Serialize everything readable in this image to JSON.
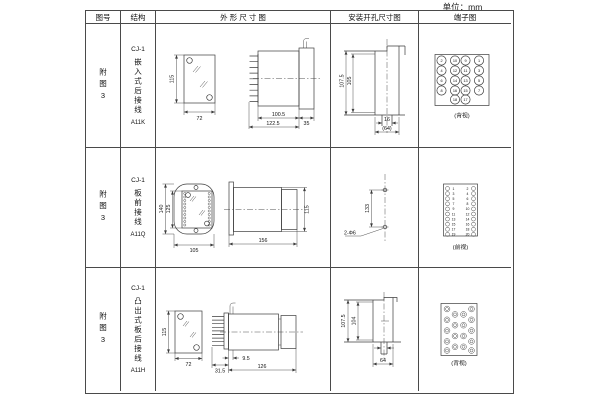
{
  "page": {
    "unit_label": "单位：mm"
  },
  "table": {
    "headers": {
      "figure": "图号",
      "structure": "结构",
      "outline": "外 形 尺 寸 图",
      "install": "安装开孔尺寸图",
      "terminal": "端子图"
    },
    "rows": [
      {
        "figure_no": "附图3",
        "structure": {
          "model": "CJ-1",
          "type": "嵌入式后接线",
          "code": "A11K"
        },
        "outline": {
          "front_height": "115",
          "front_width": "72",
          "body_length": "100.5",
          "overall_length": "122.5",
          "flange_depth": "35"
        },
        "install": {
          "outer_height": "107.5",
          "inner_height": "105",
          "slot_width": "16",
          "overall_width": "(64)"
        },
        "terminal": {
          "view_label": "(背视)",
          "rows": [
            [
              "2",
              "10",
              "9",
              "1"
            ],
            [
              "4",
              "12",
              "11",
              "3"
            ],
            [
              "6",
              "14",
              "13",
              "5"
            ],
            [
              "8",
              "16",
              "15",
              "7"
            ],
            [
              "18",
              "17"
            ]
          ]
        }
      },
      {
        "figure_no": "附图3",
        "structure": {
          "model": "CJ-1",
          "type": "板前接线",
          "code": "A11Q"
        },
        "outline": {
          "plate_height": "140",
          "window_height": "125",
          "plate_width": "105",
          "overall_length": "156",
          "body_height": "115"
        },
        "install": {
          "hole_spacing": "133",
          "hole_label": "2-Φ6"
        },
        "terminal": {
          "view_label": "(前视)",
          "left_numbers": [
            "1",
            "3",
            "5",
            "7",
            "9",
            "11",
            "13",
            "15",
            "17",
            "19"
          ],
          "right_numbers": [
            "2",
            "4",
            "6",
            "8",
            "10",
            "12",
            "14",
            "16",
            "18",
            "20"
          ]
        }
      },
      {
        "figure_no": "附图3",
        "structure": {
          "model": "CJ-1",
          "type": "凸出式板后接线",
          "code": "A11H"
        },
        "outline": {
          "front_height": "115",
          "front_width": "72",
          "pin_depth": "31.5",
          "plate_gap": "9.5",
          "body_length": "126"
        },
        "install": {
          "outer_height": "107.5",
          "inner_height": "104",
          "overall_width": "64"
        },
        "terminal": {
          "view_label": "(背视)"
        }
      }
    ]
  }
}
